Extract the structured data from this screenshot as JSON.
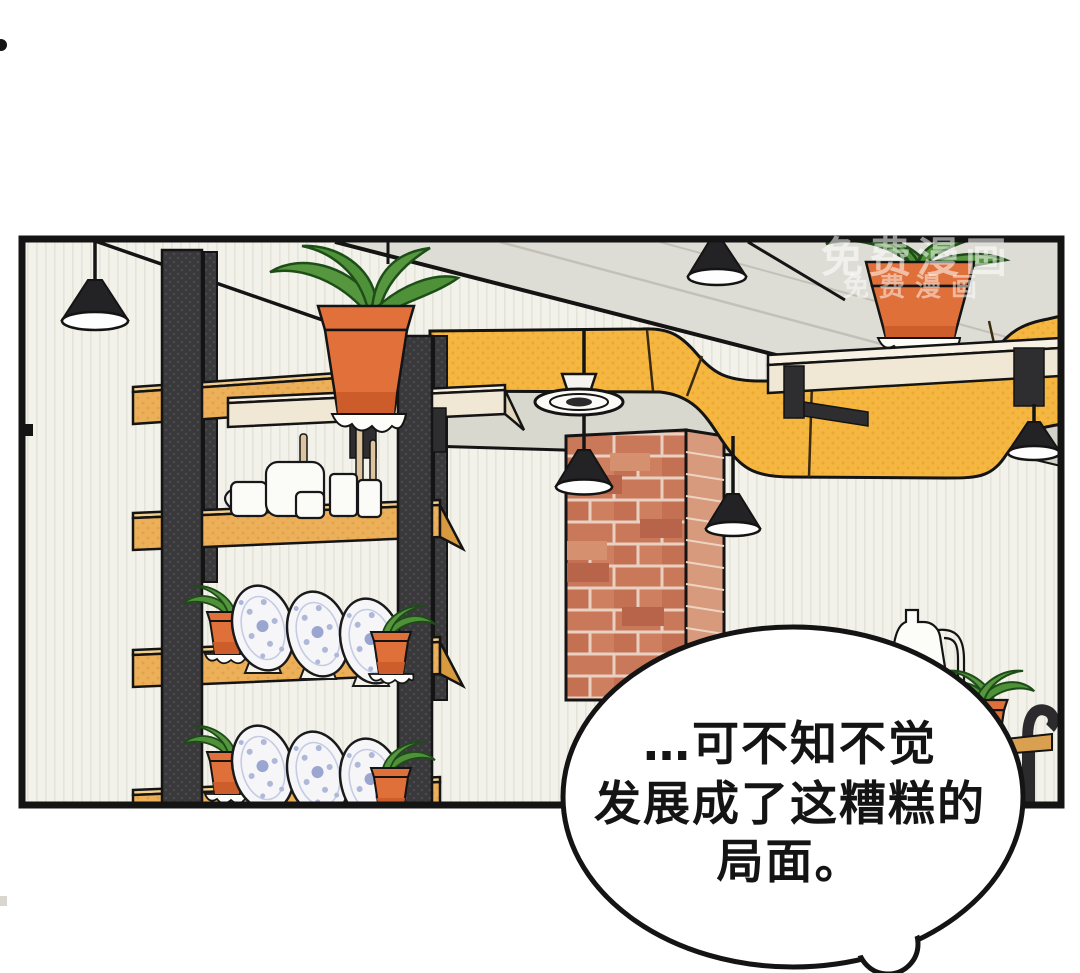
{
  "image": {
    "kind": "webtoon-comic-panel",
    "width_px": 1080,
    "height_px": 973
  },
  "speech_bubble": {
    "lines": [
      "…可不知不觉",
      "发展成了这糟糕的",
      "局面。"
    ]
  },
  "watermark": {
    "line1": "免费漫画",
    "line2": "免费漫画"
  },
  "colors": {
    "page_background": "#ffffff",
    "panel_background": "#f2f1ea",
    "panel_border": "#141414",
    "duct_yellow": "#f5b742",
    "wood_orange": "#edb05a",
    "wood_cream": "#f0e8d5",
    "beam_gray": "#deddd5",
    "post_dark": "#39393b",
    "brick_red": "#c9795a",
    "brick_mortar": "#e9d0c0",
    "terracotta_pot": "#e0703a",
    "plant_green": "#55963e",
    "plate_blue": "#aeb8d9",
    "bubble_fill": "#ffffff",
    "watermark_white": "rgba(255,255,255,0.55)"
  },
  "scene": {
    "objects": [
      "comic-panel",
      "speech-bubble",
      "watermark",
      "pendant-lamp-top-left",
      "pendant-lamp-top-middle",
      "pendant-lamp-mid-left",
      "pendant-lamp-mid-right",
      "pendant-lamp-right",
      "yellow-air-duct",
      "ceiling-beams",
      "ceiling-vent-fan",
      "brick-column",
      "wall-shelf-unit",
      "shelf-cups-and-jars",
      "decorative-plates",
      "potted-plants",
      "cream-wall-shelf",
      "white-jug",
      "small-bottle",
      "pipe-bracket-shelf"
    ]
  }
}
